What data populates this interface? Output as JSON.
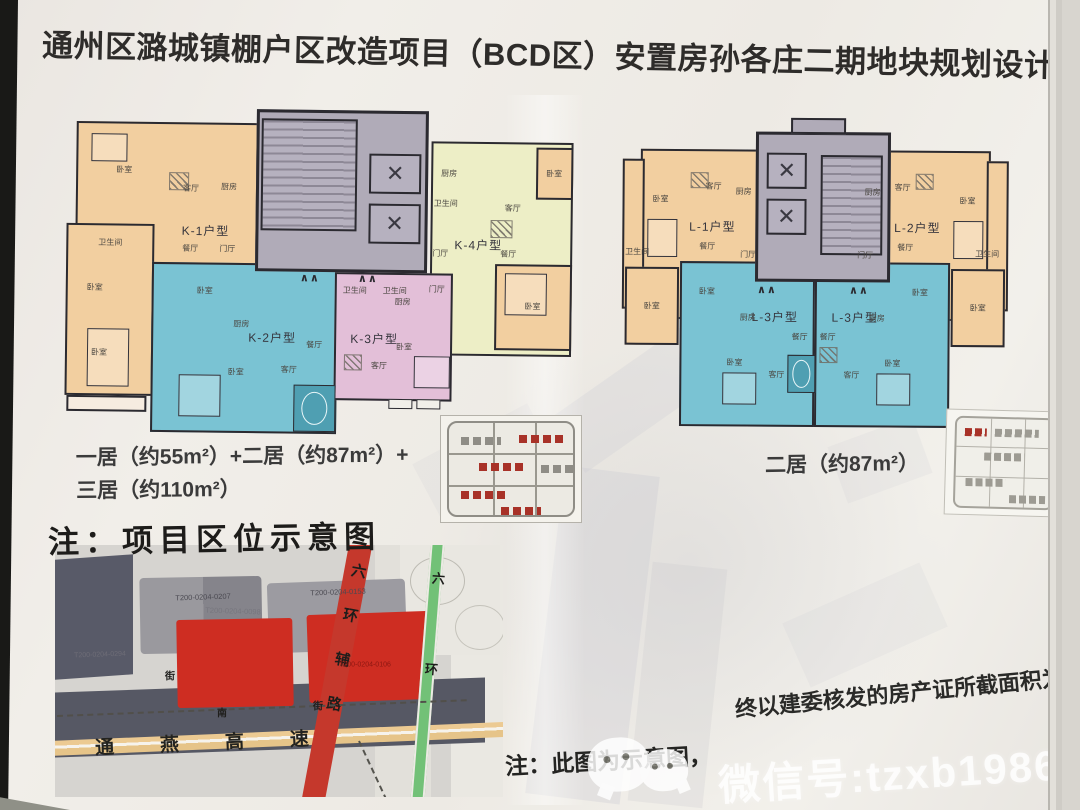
{
  "title": "通州区潞城镇棚户区改造项目（BCD区）安置房孙各庄二期地块规划设计方案",
  "summary": {
    "left_line1": "一居（约55m²）+二居（约87m²）+",
    "left_line2": "三居（约110m²）",
    "right": "二居（约87m²）"
  },
  "room_labels": {
    "bedroom": "卧室",
    "living": "客厅",
    "dining": "餐厅",
    "kitchen": "厨房",
    "bath": "卫生间",
    "foyer": "门厅"
  },
  "plans": {
    "left_units": {
      "k1": "K-1户型",
      "k2": "K-2户型",
      "k3": "K-3户型",
      "k4": "K-4户型"
    },
    "right_units": {
      "l1": "L-1户型",
      "l2": "L-2户型",
      "l3a": "L-3户型",
      "l3b": "L-3户型"
    }
  },
  "icons": {
    "elevator_cross": "✕",
    "door_mark": "∧∧",
    "wechat": "wechat-bubbles-icon"
  },
  "map": {
    "heading": "注：项目区位示意图",
    "parcels": {
      "gray_1": "T200-0204-0207",
      "gray_2": "T200-0204-0098",
      "gray_3": "T200-0204-0153",
      "dark_1": "T200-0204-0294",
      "red_1": "T200-0204-0106"
    },
    "roads": {
      "ring_aux": "六环辅路",
      "ring": "六环",
      "expressway": "通燕高速",
      "street_frag_1": "街",
      "street_frag_2": "南",
      "street_frag_3": "街"
    }
  },
  "note": {
    "left": "注：此图为示意图，",
    "right": "终以建委核发的房产证所截面积为准"
  },
  "watermark": "微信号:tzxb1986",
  "colors": {
    "unit_orange": "#f2cfa0",
    "unit_cyan": "#7ac3d3",
    "unit_pink": "#e3bfd8",
    "unit_yellow": "#edeec6",
    "core_gray": "#b0abb8",
    "parcel_red": "#ce2d22",
    "road_red": "#c5382c",
    "road_green": "#72c177",
    "expressway_tan": "#ecca92"
  }
}
